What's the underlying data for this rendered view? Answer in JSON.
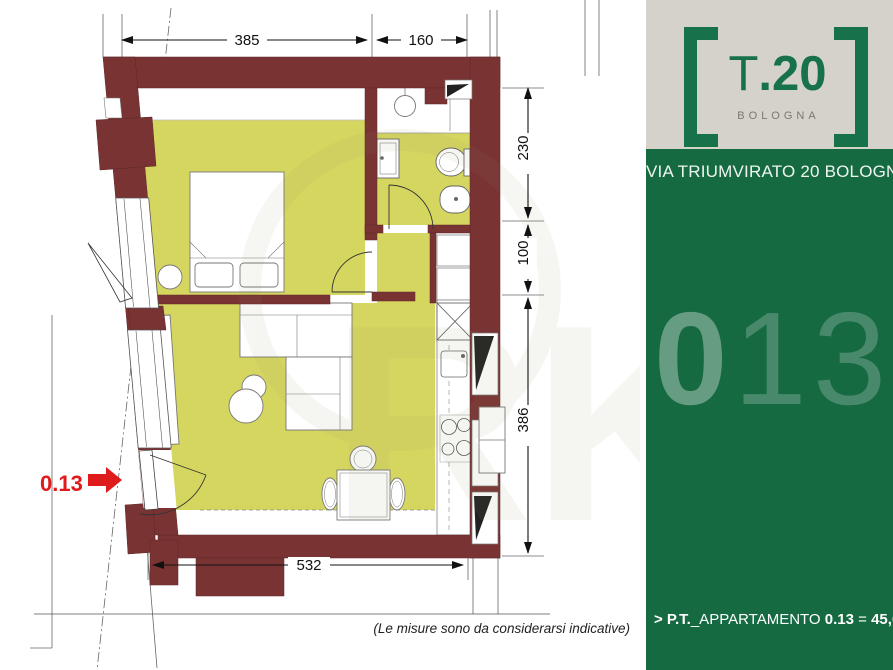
{
  "plan": {
    "dimensions": {
      "top": [
        "385",
        "160"
      ],
      "right": [
        "230",
        "100",
        "386"
      ],
      "bottom": "532"
    },
    "entry_label": "0.13",
    "note": "(Le misure sono da considerarsi indicative)"
  },
  "sidebar": {
    "logo": {
      "title_t": "T",
      "title_rest": ".20",
      "city": "BOLOGNA"
    },
    "address": "VIA TRIUMVIRATO 20 BOLOGNA",
    "big_number": {
      "first": "0",
      "rest": "13"
    },
    "caption": {
      "prefix": "> P.T.",
      "label": "_APPARTAMENTO ",
      "unit": "0.13",
      "eq": " = ",
      "area": "45,60",
      "suffix": "mq"
    }
  },
  "colors": {
    "wall": "#7a3333",
    "floor": "#d5d660",
    "brand_green": "#177249",
    "panel_green": "#166a42",
    "logo_bg": "#d5d2cc",
    "entry_red": "#e01b1b",
    "dimension_line": "#111111"
  }
}
